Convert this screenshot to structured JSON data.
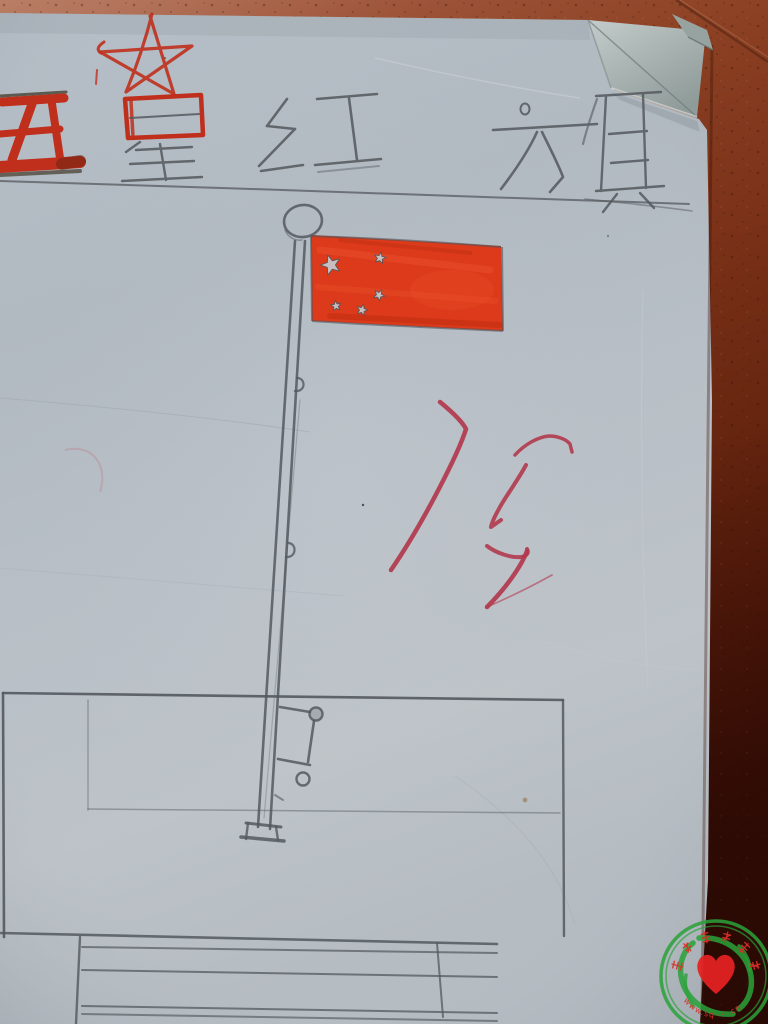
{
  "scene": {
    "subject": "Child's pencil and crayon drawing of the Five-star Red Flag on a flagpole with a stepped pedestal, on a sheet of paper lying on red floor tiles, top-right corner of the paper folded over"
  },
  "drawing": {
    "title_text": "五星红旗",
    "title_chars": [
      "五",
      "星",
      "红",
      "旗"
    ],
    "marker_red": "#bf2f1c",
    "pencil_color": "#54595e",
    "flag": {
      "color": "#dc3a1a",
      "outline_color": "#4f545a",
      "star_fill": "#c6cbce",
      "star_count": 5,
      "stars": [
        {
          "x": 331,
          "y": 265,
          "r": 10.5,
          "rot": -18
        },
        {
          "x": 380,
          "y": 258,
          "r": 6.2,
          "rot": 12
        },
        {
          "x": 379,
          "y": 295,
          "r": 6.0,
          "rot": 30
        },
        {
          "x": 336,
          "y": 306,
          "r": 5.6,
          "rot": -8
        },
        {
          "x": 362,
          "y": 310,
          "r": 6.0,
          "rot": 16
        }
      ]
    },
    "red_pen": {
      "color": "#b23a4e",
      "gloss": "red cursive teacher mark (illegible, resembles 优)"
    }
  },
  "watermark": {
    "arc_text": "丰年爱心联盟",
    "url_text": "www.sq····.cn",
    "ring_color": "#2aa23a",
    "heart_color": "#e32222",
    "text_color": "#d83028"
  }
}
